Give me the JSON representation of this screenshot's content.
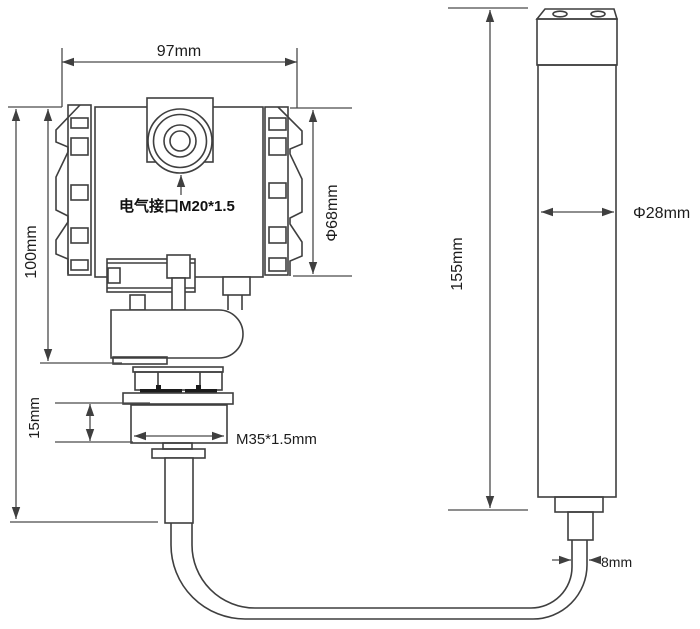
{
  "drawing": {
    "labels": {
      "housing_width": "97mm",
      "housing_height": "100mm",
      "housing_diameter": "Φ68mm",
      "electrical_port": "电气接口M20*1.5",
      "thread_height": "15mm",
      "thread_spec": "M35*1.5mm",
      "probe_length": "155mm",
      "probe_diameter": "Φ28mm",
      "cable_diameter": "8mm"
    },
    "colors": {
      "background": "#ffffff",
      "line": "#3f3f3f",
      "text": "#1c1c1c"
    }
  }
}
